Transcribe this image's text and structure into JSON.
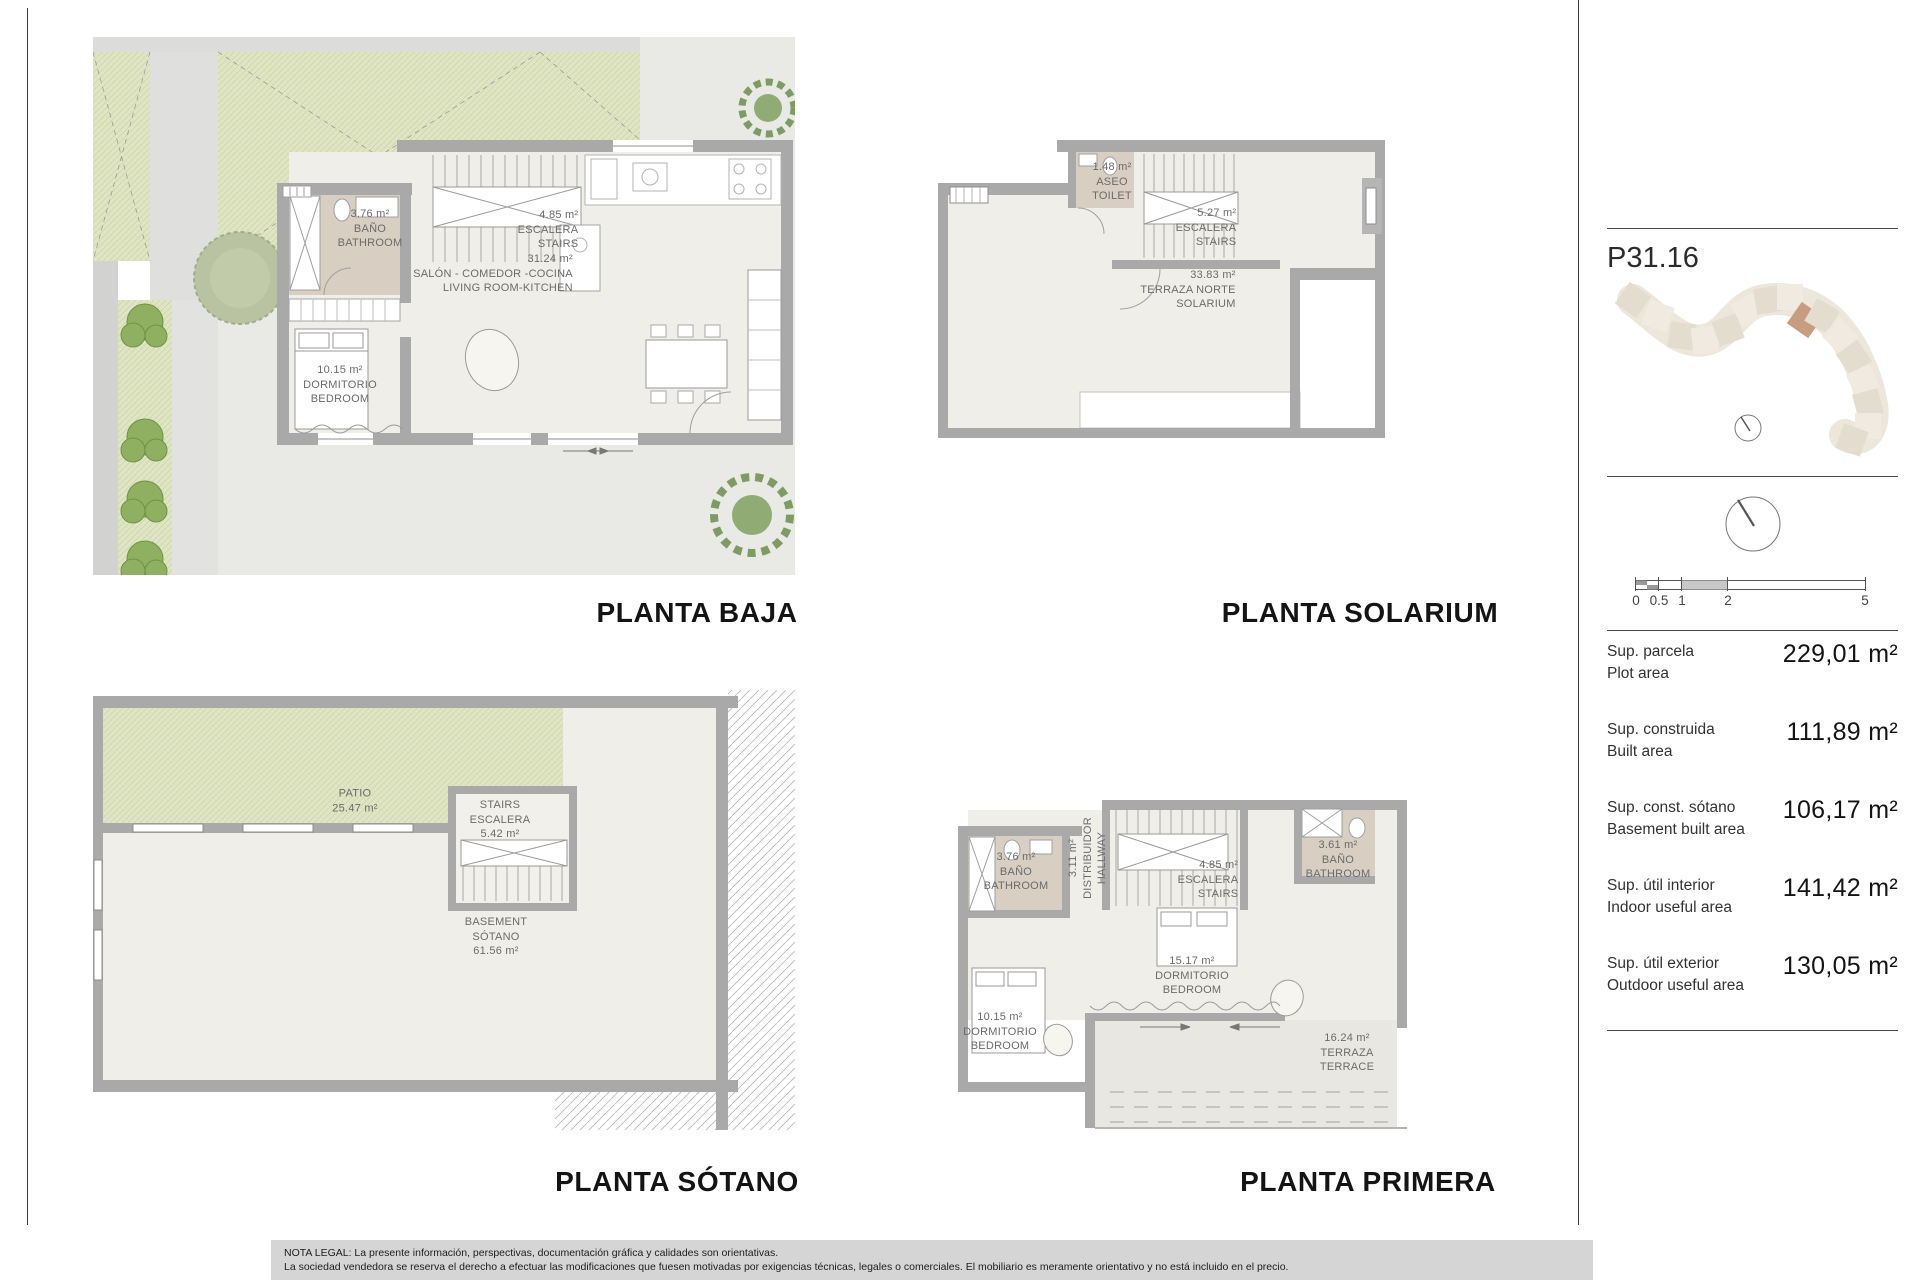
{
  "unit": {
    "code": "P31.16"
  },
  "plans": {
    "baja": {
      "title": "PLANTA BAJA",
      "rooms": {
        "bath": {
          "area": "3.76 m²",
          "es": "BAÑO",
          "en": "BATHROOM"
        },
        "stairs": {
          "area": "4.85 m²",
          "es": "ESCALERA",
          "en": "STAIRS"
        },
        "living": {
          "area": "31.24 m²",
          "es": "SALÓN - COMEDOR -COCINA",
          "en": "LIVING ROOM-KITCHEN"
        },
        "bedroom": {
          "area": "10.15 m²",
          "es": "DORMITORIO",
          "en": "BEDROOM"
        }
      }
    },
    "solarium": {
      "title": "PLANTA SOLARIUM",
      "rooms": {
        "toilet": {
          "area": "1.48 m²",
          "es": "ASEO",
          "en": "TOILET"
        },
        "stairs": {
          "area": "5.27 m²",
          "es": "ESCALERA",
          "en": "STAIRS"
        },
        "terrace": {
          "area": "33.83 m²",
          "es": "TERRAZA NORTE",
          "en": "SOLARIUM"
        }
      }
    },
    "sotano": {
      "title": "PLANTA SÓTANO",
      "rooms": {
        "patio": {
          "es": "PATIO",
          "area": "25.47 m²"
        },
        "stairs": {
          "en": "STAIRS",
          "es": "ESCALERA",
          "area": "5.42 m²"
        },
        "basement": {
          "en": "BASEMENT",
          "es": "SÓTANO",
          "area": "61.56 m²"
        }
      }
    },
    "primera": {
      "title": "PLANTA PRIMERA",
      "rooms": {
        "bath_left": {
          "area": "3.76 m²",
          "es": "BAÑO",
          "en": "BATHROOM"
        },
        "hallway": {
          "area": "3.11 m²",
          "es": "DISTRIBUIDOR",
          "en": "HALLWAY"
        },
        "stairs": {
          "area": "4.85 m²",
          "es": "ESCALERA",
          "en": "STAIRS"
        },
        "bath_right": {
          "area": "3.61 m²",
          "es": "BAÑO",
          "en": "BATHROOM"
        },
        "bedroom_main": {
          "area": "15.17 m²",
          "es": "DORMITORIO",
          "en": "BEDROOM"
        },
        "bedroom_left": {
          "area": "10.15 m²",
          "es": "DORMITORIO",
          "en": "BEDROOM"
        },
        "terrace": {
          "area": "16.24 m²",
          "es": "TERRAZA",
          "en": "TERRACE"
        }
      }
    }
  },
  "sidebar": {
    "scale_ticks": [
      "0",
      "0.5",
      "1",
      "2",
      "5"
    ],
    "metrics": [
      {
        "es": "Sup. parcela",
        "en": "Plot area",
        "value": "229,01 m²"
      },
      {
        "es": "Sup. construida",
        "en": "Built area",
        "value": "111,89 m²"
      },
      {
        "es": "Sup. const. sótano",
        "en": "Basement built area",
        "value": "106,17 m²"
      },
      {
        "es": "Sup. útil interior",
        "en": "Indoor useful area",
        "value": "141,42 m²"
      },
      {
        "es": "Sup. útil exterior",
        "en": "Outdoor useful area",
        "value": "130,05 m²"
      }
    ],
    "colors": {
      "highlight_unit": "#c79d7f",
      "wall": "#a9a9a9",
      "garden": "#dfe5c5",
      "bath_floor": "#d8cec2"
    }
  },
  "legal": {
    "line1": "NOTA LEGAL: La presente información, perspectivas, documentación gráfica y calidades son orientativas.",
    "line2": "La sociedad vendedora se reserva el derecho a efectuar las modificaciones que fuesen motivadas por exigencias técnicas, legales o comerciales. El mobiliario es meramente orientativo y no está incluido en el precio."
  }
}
